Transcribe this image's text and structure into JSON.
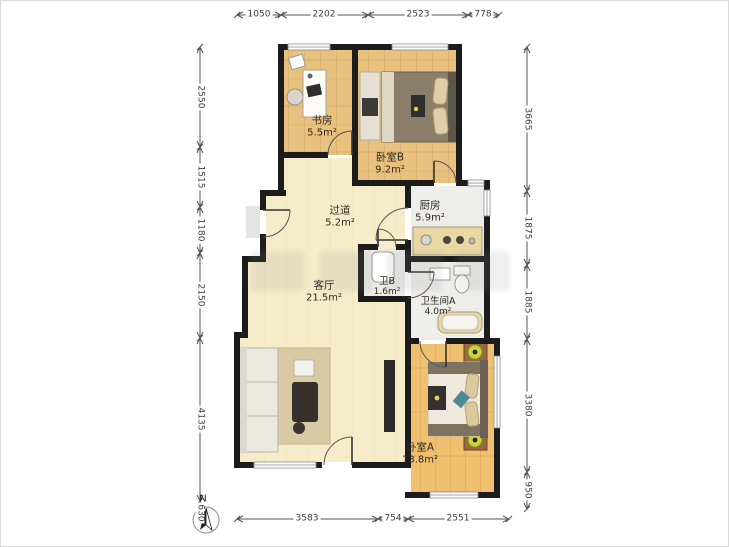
{
  "compass": {
    "label": "N"
  },
  "rooms": {
    "study": {
      "name": "书房",
      "area": "5.5m²"
    },
    "bedroom_b": {
      "name": "卧室B",
      "area": "9.2m²"
    },
    "hallway": {
      "name": "过道",
      "area": "5.2m²"
    },
    "kitchen": {
      "name": "厨房",
      "area": "5.9m²"
    },
    "living": {
      "name": "客厅",
      "area": "21.5m²"
    },
    "bath_b": {
      "name": "卫B",
      "area": "1.6m²"
    },
    "bath_a": {
      "name": "卫生间A",
      "area": "4.0m²"
    },
    "bedroom_a": {
      "name": "卧室A",
      "area": "13.8m²"
    }
  },
  "dimensions": {
    "top": [
      "1050",
      "2202",
      "2523",
      "778"
    ],
    "bottom": [
      "3583",
      "754",
      "2551"
    ],
    "left": [
      "2550",
      "1515",
      "1180",
      "2150",
      "4135",
      "630"
    ],
    "right": [
      "3665",
      "1875",
      "1885",
      "3380",
      "950"
    ]
  },
  "colors": {
    "wall": "#1c1c1c",
    "wood_floor": "#e8c17e",
    "wood_floor_bright": "#eec06f",
    "cream_floor": "#f6ecca",
    "tile_floor": "#ededea",
    "counter_tan": "#e9d7a4",
    "lamp_yellow": "#ccd23c"
  }
}
